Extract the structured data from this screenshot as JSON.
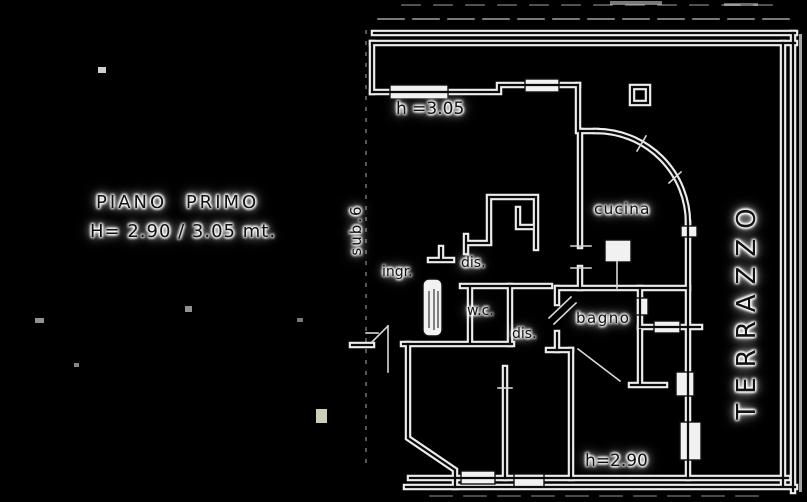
{
  "drawing": {
    "floor_title": "PIANO PRIMO",
    "floor_heights": "H= 2.90 / 3.05 mt.",
    "annotations": {
      "height_upper": "h =3.05",
      "height_lower": "h=2.90"
    },
    "rooms": {
      "stairwell": "sub.6",
      "entrance": "ingr.",
      "hall_1": "dis.",
      "toilet": "w.c.",
      "hall_2": "dis.",
      "bathroom": "bagno",
      "kitchen": "cucina",
      "terrace": "TERRAZZO"
    },
    "colors": {
      "background": "#000000",
      "line_halo": "#ededed",
      "ink": "#121212"
    }
  }
}
